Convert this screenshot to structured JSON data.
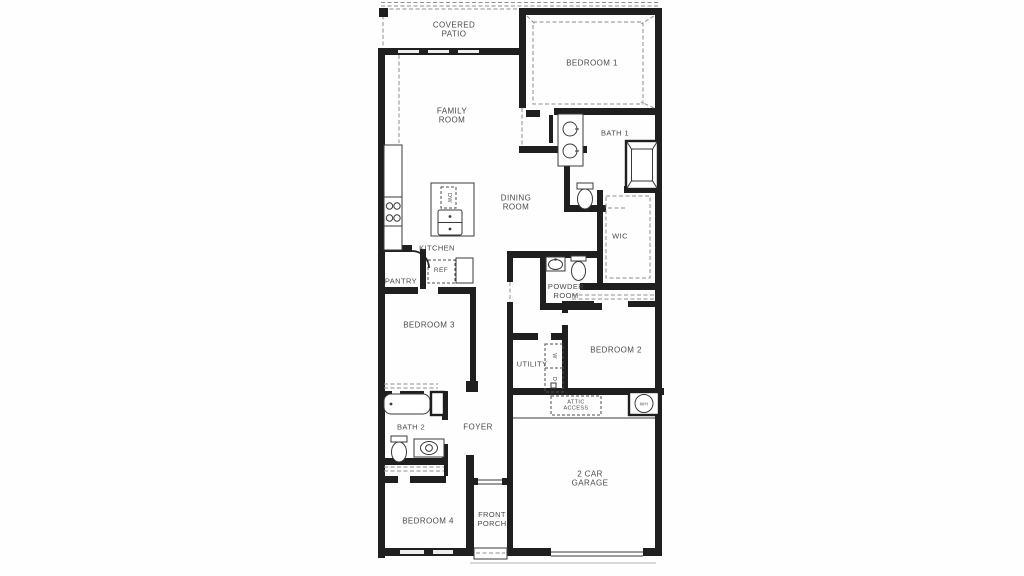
{
  "floor_plan": {
    "colors": {
      "background": "#fefefe",
      "wall": "#1f1f1f",
      "line": "#3a3a3a",
      "dashed": "#8f8f8f",
      "label": "#4a4a4a"
    },
    "labels": [
      {
        "id": "covered-patio",
        "text": "COVERED\nPATIO",
        "x": 454,
        "y": 30,
        "fs": 8,
        "rot": 0
      },
      {
        "id": "bedroom-1",
        "text": "BEDROOM 1",
        "x": 592,
        "y": 63,
        "fs": 8,
        "rot": 0
      },
      {
        "id": "family-room",
        "text": "FAMILY\nROOM",
        "x": 452,
        "y": 116,
        "fs": 8,
        "rot": 0
      },
      {
        "id": "bath-1",
        "text": "BATH 1",
        "x": 615,
        "y": 134,
        "fs": 7.5,
        "rot": 0
      },
      {
        "id": "dining-room",
        "text": "DINING\nROOM",
        "x": 516,
        "y": 203,
        "fs": 8,
        "rot": 0
      },
      {
        "id": "wic",
        "text": "WIC",
        "x": 620,
        "y": 237,
        "fs": 7.5,
        "rot": 0
      },
      {
        "id": "kitchen",
        "text": "KITCHEN",
        "x": 437,
        "y": 249,
        "fs": 7.5,
        "rot": 0
      },
      {
        "id": "ref",
        "text": "REF",
        "x": 441,
        "y": 271,
        "fs": 6.5,
        "rot": 0
      },
      {
        "id": "pantry",
        "text": "PANTRY",
        "x": 401,
        "y": 282,
        "fs": 7.5,
        "rot": 0
      },
      {
        "id": "powder-room",
        "text": "POWDER\nROOM",
        "x": 566,
        "y": 292,
        "fs": 7.5,
        "rot": 0
      },
      {
        "id": "bedroom-3",
        "text": "BEDROOM 3",
        "x": 429,
        "y": 325,
        "fs": 8,
        "rot": 0
      },
      {
        "id": "bedroom-2",
        "text": "BEDROOM 2",
        "x": 616,
        "y": 350,
        "fs": 8,
        "rot": 0
      },
      {
        "id": "utility",
        "text": "UTILITY",
        "x": 532,
        "y": 365,
        "fs": 7.5,
        "rot": 0
      },
      {
        "id": "attic-access",
        "text": "ATTIC\nACCESS",
        "x": 576,
        "y": 406,
        "fs": 5.5,
        "rot": 0
      },
      {
        "id": "wh",
        "text": "WH",
        "x": 644,
        "y": 404,
        "fs": 4.5,
        "rot": 0
      },
      {
        "id": "bath-2",
        "text": "BATH 2",
        "x": 411,
        "y": 428,
        "fs": 7.5,
        "rot": 0
      },
      {
        "id": "foyer",
        "text": "FOYER",
        "x": 478,
        "y": 427,
        "fs": 8,
        "rot": 0
      },
      {
        "id": "garage",
        "text": "2 CAR\nGARAGE",
        "x": 590,
        "y": 479,
        "fs": 8,
        "rot": 0
      },
      {
        "id": "bedroom-4",
        "text": "BEDROOM 4",
        "x": 428,
        "y": 521,
        "fs": 8,
        "rot": 0
      },
      {
        "id": "front-porch",
        "text": "FRONT\nPORCH",
        "x": 492,
        "y": 520,
        "fs": 7.5,
        "rot": 0
      },
      {
        "id": "dishwasher",
        "text": "DW",
        "x": 448.5,
        "y": 197.5,
        "fs": 5.5,
        "rot": 90
      },
      {
        "id": "washer",
        "text": "W",
        "x": 554,
        "y": 356,
        "fs": 5.5,
        "rot": 90
      },
      {
        "id": "dryer",
        "text": "D",
        "x": 554,
        "y": 379,
        "fs": 5.5,
        "rot": 90
      }
    ]
  }
}
